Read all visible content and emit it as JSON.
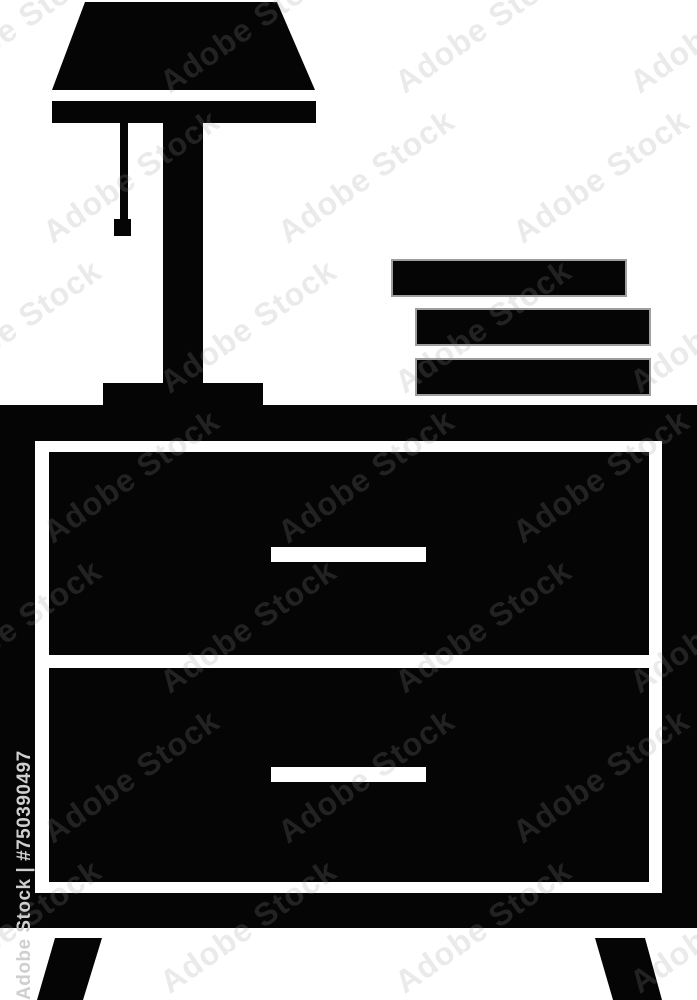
{
  "image": {
    "description": "Black glyph icon of a nightstand with two drawers, a pull-chain table lamp on top and a stack of three books",
    "background_color": "#ffffff",
    "icon_color": "#050505",
    "handle_color": "#ffffff",
    "book_outline_color": "#9e9e9e"
  },
  "watermark": {
    "tile_text": "Adobe Stock",
    "id_text": "Adobe Stock | #750390497",
    "tile_color": "rgba(150,150,150,0.20)",
    "id_color": "#cfcfcf"
  }
}
